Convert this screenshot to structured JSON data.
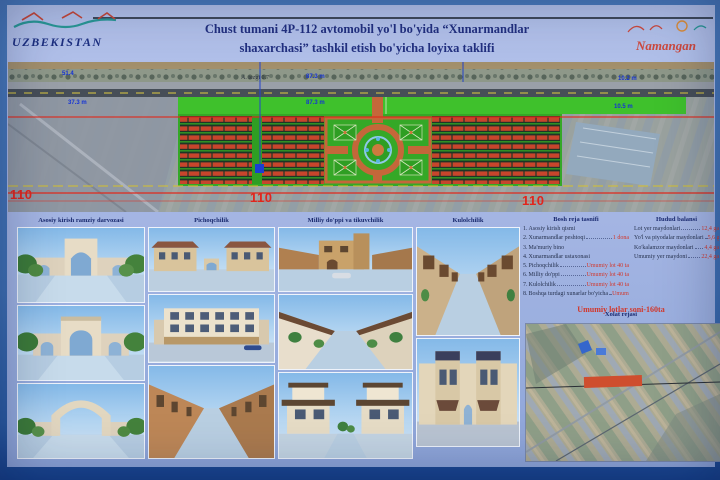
{
  "header": {
    "logo_left_text": "UZBEKISTAN",
    "logo_right_text": "Namangan",
    "title_line1": "Chust tumani 4P-112 avtomobil yo'l bo'yida “Xunarmandlar",
    "title_line2": "shaxarchasi” tashkil etish bo'yicha loyixa taklifi"
  },
  "siteplan": {
    "note_label": "A. tezgi 0.7",
    "dims": {
      "d1": "51.4",
      "d2": "37.3 m",
      "d3": "87.3 m",
      "d4": "87.3 m",
      "d5": "10.2 m",
      "d6": "10.5 m"
    },
    "stations": {
      "s1": "110",
      "s2": "110",
      "s3": "110"
    }
  },
  "gallery": {
    "col1_label": "Asosiy kirish ramziy darvozasi",
    "col2_label": "Pichoqchilik",
    "col3_label": "Milliy do'ppi va tikuvchilik",
    "col4_label": "Kulolchilik"
  },
  "info": {
    "left_title": "Bosh reja tasnifi",
    "items": [
      {
        "num": "1.",
        "label": "Asosiy kirish qismi",
        "value": ""
      },
      {
        "num": "2.",
        "label": "Xunarmandlar peshtoqi",
        "value": "1 dona"
      },
      {
        "num": "3.",
        "label": "Ma'muriy bino",
        "value": ""
      },
      {
        "num": "4.",
        "label": "Xunarmandlar ustaxonasi",
        "value": ""
      },
      {
        "num": "5.",
        "label": "Pichoqchilik",
        "value": "Umumiy lot 40 ta"
      },
      {
        "num": "6.",
        "label": "Milliy do'ppi",
        "value": "Umumiy lot 40 ta"
      },
      {
        "num": "7.",
        "label": "Kulolchilik",
        "value": "Umumiy lot 40 ta"
      },
      {
        "num": "8.",
        "label": "Boshqa turdagi xunarlar bo'yicha",
        "value": "Umumiy lot 40 ta"
      }
    ],
    "right_title": "Hudud balansi",
    "areas": [
      {
        "label": "Lot yer maydonlari",
        "value": "12,4 ga"
      },
      {
        "label": "Yo'l va piyodalar maydonlari",
        "value": "5,6 ga"
      },
      {
        "label": "Ko'kalamzor maydonlari",
        "value": "4,4 ga"
      },
      {
        "label": "Umumiy yer maydoni",
        "value": "22,4 ga"
      }
    ],
    "total": "Umumiy lotlar soni-160ta",
    "map_title": "Xolat rejasi"
  }
}
